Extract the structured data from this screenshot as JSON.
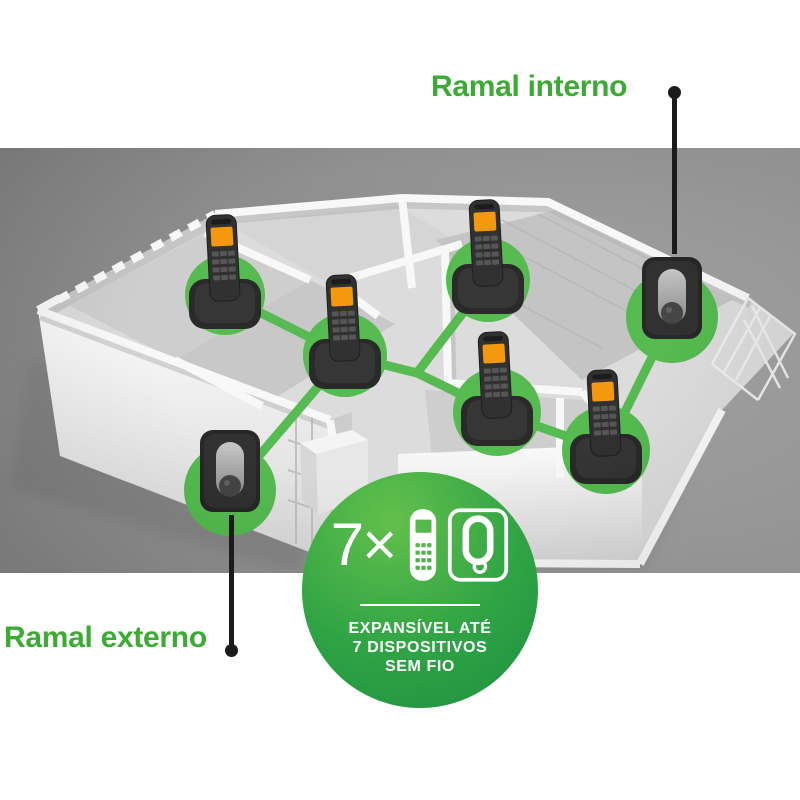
{
  "title_labels": {
    "internal": "Ramal interno",
    "external": "Ramal externo"
  },
  "badge": {
    "multiplier": "7×",
    "lines": [
      "EXPANSÍVEL ATÉ",
      "7 DISPOSITIVOS",
      "SEM FIO"
    ],
    "icons": [
      "cordless-handset-icon",
      "base-station-icon"
    ]
  },
  "colors": {
    "label_green": "#3BAB33",
    "network_green": "#4DB748",
    "badge_light": "#63C04C",
    "badge_mid": "#2FA344",
    "badge_dark": "#1C9140",
    "pointer_black": "#1B1B1B",
    "handset_screen_orange": "#F39200",
    "scene_background": "#8D8D8D"
  },
  "network": {
    "devices": [
      {
        "id": "handset-1",
        "type": "handset",
        "x": 225,
        "y": 147,
        "r": 40
      },
      {
        "id": "handset-2",
        "type": "handset",
        "x": 345,
        "y": 207,
        "r": 42
      },
      {
        "id": "handset-3",
        "type": "handset",
        "x": 488,
        "y": 132,
        "r": 42
      },
      {
        "id": "handset-4",
        "type": "handset",
        "x": 497,
        "y": 264,
        "r": 44
      },
      {
        "id": "handset-5",
        "type": "handset",
        "x": 606,
        "y": 302,
        "r": 44
      },
      {
        "id": "external-unit",
        "type": "wall-unit",
        "x": 230,
        "y": 342,
        "r": 46
      },
      {
        "id": "internal-unit",
        "type": "wall-unit",
        "x": 672,
        "y": 169,
        "r": 46
      }
    ],
    "junctions": [
      {
        "id": "junction-1",
        "x": 417,
        "y": 225
      }
    ],
    "links": [
      [
        "handset-1",
        "handset-2"
      ],
      [
        "handset-2",
        "junction-1"
      ],
      [
        "junction-1",
        "handset-3"
      ],
      [
        "junction-1",
        "handset-4"
      ],
      [
        "handset-4",
        "handset-5"
      ],
      [
        "handset-5",
        "internal-unit"
      ],
      [
        "handset-2",
        "external-unit"
      ]
    ]
  }
}
